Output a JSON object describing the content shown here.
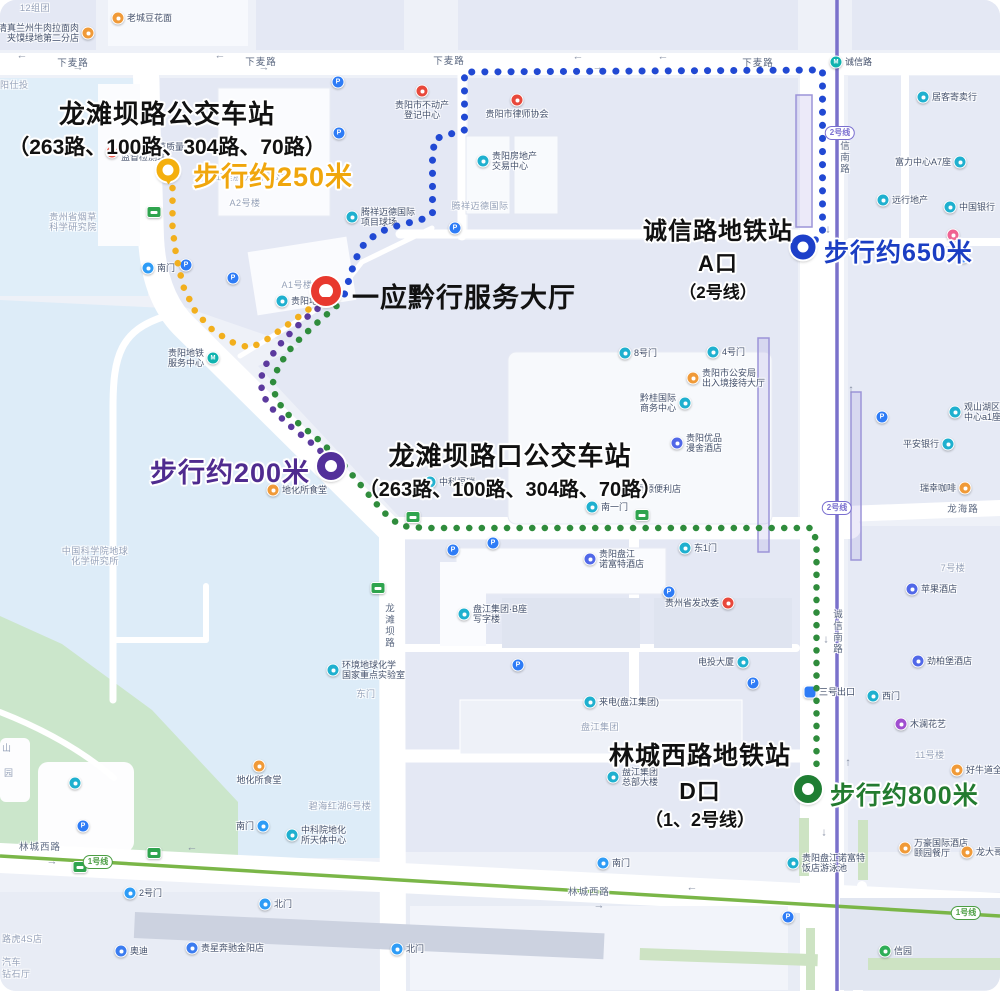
{
  "colors": {
    "route_yellow": "#F2AF1D",
    "route_blue": "#2149D3",
    "route_purple": "#5C3A9E",
    "route_green": "#2F8C3C",
    "walk_yellow": "#F0A60C",
    "walk_blue": "#1B3EC3",
    "walk_purple": "#4F2B8F",
    "walk_green": "#237B2F",
    "marker_red": "#E8392E",
    "metro_line2": "#7a71cb",
    "metro_line1": "#7ab648"
  },
  "stations": {
    "bus_longtanba": {
      "name": "龙滩坝路公交车站",
      "lines": "（263路、100路、304路、70路）",
      "walk": "步行约250米"
    },
    "metro_chengxin": {
      "name": "诚信路地铁站",
      "exit": "A口",
      "line": "（2号线）",
      "walk": "步行约650米"
    },
    "hall": {
      "name": "一应黔行服务大厅"
    },
    "bus_longtanbakou": {
      "name": "龙滩坝路口公交车站",
      "lines": "（263路、100路、304路、70路）",
      "walk": "步行约200米"
    },
    "metro_lincheng": {
      "name": "林城西路地铁站",
      "exit": "D口",
      "line": "（1、2号线）",
      "walk": "步行约800米"
    }
  },
  "markers": [
    {
      "id": "bus-longtanba",
      "type": "pin",
      "color": "#F4AF0D",
      "x": 168,
      "y": 170,
      "d": 11,
      "ring": 6
    },
    {
      "id": "service-hall",
      "type": "pin",
      "color": "#E8392E",
      "x": 326,
      "y": 291,
      "d": 14,
      "ring": 8
    },
    {
      "id": "metro-chengxin-a",
      "type": "donut",
      "color": "#1D3FC9",
      "x": 803,
      "y": 247,
      "d": 11,
      "ring": 7
    },
    {
      "id": "bus-longtanbakou",
      "type": "donut",
      "color": "#53309A",
      "x": 331,
      "y": 466,
      "d": 12,
      "ring": 8
    },
    {
      "id": "metro-lincheng-d",
      "type": "donut",
      "color": "#1F7E33",
      "x": 808,
      "y": 789,
      "d": 12,
      "ring": 8
    }
  ],
  "routes": [
    {
      "id": "yellow-250m",
      "color": "#F2AF1D",
      "w": 6.5,
      "gap": 12.5,
      "points": "168,188 168,228 172,258 179,287 191,312 208,330 227,342 246,348 263,339 287,322 306,308 319,298"
    },
    {
      "id": "blue-650m",
      "color": "#2149D3",
      "w": 7,
      "gap": 13,
      "points": "340,294 345,278 350,262 357,247 368,237 382,229 399,224 416,220 428,214 428,160 430,139 446,134 460,130 460,72 818,70 818,234 807,243"
    },
    {
      "id": "purple-200m",
      "color": "#5C3A9E",
      "w": 6.5,
      "gap": 12.5,
      "points": "323,301 300,319 279,340 263,361 256,379 258,395 268,409 282,423 298,436 312,447 321,456"
    },
    {
      "id": "green-800m",
      "color": "#2F8C3C",
      "w": 6.5,
      "gap": 12.5,
      "points": "332,306 309,326 288,346 274,366 268,384 272,400 283,414 297,426 312,438 327,452 342,468 357,486 372,504 384,517 397,526 420,528 808,528 812,542 812,766 809,774"
    }
  ],
  "road_labels": [
    {
      "t": "下麦路",
      "x": 73,
      "y": 62
    },
    {
      "t": "下麦路",
      "x": 261,
      "y": 61
    },
    {
      "t": "下麦路",
      "x": 449,
      "y": 60
    },
    {
      "t": "下麦路",
      "x": 758,
      "y": 62
    },
    {
      "t": "诚信南路",
      "x": 843,
      "y": 152,
      "v": true
    },
    {
      "t": "诚信南路",
      "x": 836,
      "y": 632,
      "v": true
    },
    {
      "t": "龙滩坝路",
      "x": 388,
      "y": 626,
      "v": true
    },
    {
      "t": "林城西路",
      "x": 40,
      "y": 846
    },
    {
      "t": "林城西路",
      "x": 589,
      "y": 891
    },
    {
      "t": "龙海路",
      "x": 963,
      "y": 508
    }
  ],
  "arrows": [
    {
      "g": "←",
      "x": 22,
      "y": 56
    },
    {
      "g": "→",
      "x": 78,
      "y": 68
    },
    {
      "g": "←",
      "x": 220,
      "y": 56
    },
    {
      "g": "→",
      "x": 264,
      "y": 68
    },
    {
      "g": "←",
      "x": 578,
      "y": 57
    },
    {
      "g": "→",
      "x": 598,
      "y": 68
    },
    {
      "g": "←",
      "x": 663,
      "y": 57
    },
    {
      "g": "→",
      "x": 52,
      "y": 862
    },
    {
      "g": "←",
      "x": 192,
      "y": 848
    },
    {
      "g": "←",
      "x": 692,
      "y": 888
    },
    {
      "g": "→",
      "x": 599,
      "y": 906
    },
    {
      "g": "↓",
      "x": 828,
      "y": 230
    },
    {
      "g": "↑",
      "x": 851,
      "y": 390
    },
    {
      "g": "↓",
      "x": 826,
      "y": 640
    },
    {
      "g": "↑",
      "x": 848,
      "y": 763
    },
    {
      "g": "↓",
      "x": 824,
      "y": 833
    }
  ],
  "badges": [
    {
      "t": "2号线",
      "x": 840,
      "y": 133,
      "c": "#7a6fd0"
    },
    {
      "t": "2号线",
      "x": 837,
      "y": 508,
      "c": "#7a6fd0"
    },
    {
      "t": "1号线",
      "x": 98,
      "y": 862,
      "c": "#4c9e43"
    },
    {
      "t": "1号线",
      "x": 966,
      "y": 913,
      "c": "#4c9e43"
    }
  ],
  "pois": [
    {
      "x": 118,
      "y": 18,
      "t": "orange",
      "l": "老城豆花面",
      "lp": "r"
    },
    {
      "x": 88,
      "y": 33,
      "t": "orange",
      "l": "清真兰州牛肉拉面肉\n夹馍绿地第二分店",
      "lp": "l"
    },
    {
      "x": 112,
      "y": 152,
      "t": "red",
      "l": "贵州省烟草质量\n监督检测站",
      "lp": "r"
    },
    {
      "x": 422,
      "y": 91,
      "t": "red",
      "l": "贵阳市不动产\n登记中心",
      "lp": "b"
    },
    {
      "x": 517,
      "y": 100,
      "t": "red",
      "l": "贵阳市律师协会",
      "lp": "b"
    },
    {
      "x": 483,
      "y": 161,
      "t": "cyan",
      "l": "贵阳房地产\n交易中心",
      "lp": "r"
    },
    {
      "x": 352,
      "y": 217,
      "t": "cyan",
      "l": "腾祥迈德国际\n项目球场",
      "lp": "r"
    },
    {
      "x": 693,
      "y": 378,
      "t": "orange",
      "l": "贵阳市公安局\n出入境接待大厅",
      "lp": "r"
    },
    {
      "x": 685,
      "y": 403,
      "t": "cyan",
      "l": "黔桂国际\n商务中心",
      "lp": "l"
    },
    {
      "x": 677,
      "y": 443,
      "t": "hotel",
      "l": "贵阳优品\n漫舍酒店",
      "lp": "r"
    },
    {
      "x": 625,
      "y": 353,
      "t": "cyan",
      "l": "8号门",
      "lp": "r"
    },
    {
      "x": 713,
      "y": 352,
      "t": "cyan",
      "l": "4号门",
      "lp": "r"
    },
    {
      "x": 592,
      "y": 507,
      "t": "cyan",
      "l": "南一门",
      "lp": "r"
    },
    {
      "x": 618,
      "y": 489,
      "t": "purple",
      "l": "幸福源便利店",
      "lp": "r"
    },
    {
      "x": 430,
      "y": 482,
      "t": "cyan",
      "l": "中科恒瑞",
      "lp": "r"
    },
    {
      "x": 273,
      "y": 490,
      "t": "orange",
      "l": "地化所食堂",
      "lp": "r"
    },
    {
      "x": 259,
      "y": 766,
      "t": "orange",
      "l": "地化所食堂",
      "lp": "b"
    },
    {
      "x": 333,
      "y": 670,
      "t": "cyan",
      "l": "环境地球化学\n国家重点实验室",
      "lp": "r"
    },
    {
      "x": 95,
      "y": 556,
      "t": "label",
      "l": "中国科学院地球\n化学研究所",
      "lp": "c"
    },
    {
      "x": 73,
      "y": 222,
      "t": "label",
      "l": "贵州省烟草\n科学研究院",
      "lp": "c"
    },
    {
      "x": 245,
      "y": 203,
      "t": "label",
      "l": "A2号楼",
      "lp": "c"
    },
    {
      "x": 297,
      "y": 285,
      "t": "label",
      "l": "A1号楼",
      "lp": "c"
    },
    {
      "x": 252,
      "y": 177,
      "t": "label",
      "l": "工程股份有限公司",
      "lp": "c"
    },
    {
      "x": 480,
      "y": 206,
      "t": "label",
      "l": "腾祥迈德国际",
      "lp": "c"
    },
    {
      "x": 600,
      "y": 727,
      "t": "label",
      "l": "盘江集团",
      "lp": "c"
    },
    {
      "x": 930,
      "y": 755,
      "t": "label",
      "l": "11号楼",
      "lp": "c"
    },
    {
      "x": 953,
      "y": 568,
      "t": "label",
      "l": "7号楼",
      "lp": "c"
    },
    {
      "x": 340,
      "y": 806,
      "t": "label",
      "l": "碧海红湖6号楼",
      "lp": "c"
    },
    {
      "x": 35,
      "y": 8,
      "t": "label",
      "l": "12组团",
      "lp": "c"
    },
    {
      "x": 0,
      "y": 85,
      "t": "label",
      "l": "阳仕投",
      "lp": "o"
    },
    {
      "x": 2,
      "y": 748,
      "t": "label",
      "l": "山",
      "lp": "o"
    },
    {
      "x": 4,
      "y": 773,
      "t": "label",
      "l": "园",
      "lp": "o"
    },
    {
      "x": 2,
      "y": 939,
      "t": "label",
      "l": "路虎4S店",
      "lp": "o"
    },
    {
      "x": 2,
      "y": 962,
      "t": "label",
      "l": "汽车",
      "lp": "o"
    },
    {
      "x": 2,
      "y": 974,
      "t": "label",
      "l": "钻石厅",
      "lp": "o"
    },
    {
      "x": 366,
      "y": 694,
      "t": "label",
      "l": "东门",
      "lp": "c"
    },
    {
      "x": 148,
      "y": 268,
      "t": "gate",
      "l": "南门",
      "lp": "r"
    },
    {
      "x": 613,
      "y": 777,
      "t": "cyan",
      "l": "盘江集团\n总部大楼",
      "lp": "r"
    },
    {
      "x": 590,
      "y": 702,
      "t": "cyan",
      "l": "来电(盘江集团)",
      "lp": "r"
    },
    {
      "x": 464,
      "y": 614,
      "t": "cyan",
      "l": "盘江集团·B座\n写字楼",
      "lp": "r"
    },
    {
      "x": 590,
      "y": 559,
      "t": "hotel",
      "l": "贵阳盘江\n诺富特酒店",
      "lp": "r"
    },
    {
      "x": 728,
      "y": 603,
      "t": "red",
      "l": "贵州省发改委",
      "lp": "l"
    },
    {
      "x": 743,
      "y": 662,
      "t": "cyan",
      "l": "电投大厦",
      "lp": "l"
    },
    {
      "x": 810,
      "y": 692,
      "t": "exit",
      "l": "三号出口",
      "lp": "r"
    },
    {
      "x": 873,
      "y": 696,
      "t": "cyan",
      "l": "西门",
      "lp": "r"
    },
    {
      "x": 901,
      "y": 724,
      "t": "purple",
      "l": "木澜花艺",
      "lp": "r"
    },
    {
      "x": 957,
      "y": 770,
      "t": "orange",
      "l": "好牛道全牛馆",
      "lp": "r"
    },
    {
      "x": 912,
      "y": 589,
      "t": "hotel",
      "l": "苹果酒店",
      "lp": "r"
    },
    {
      "x": 918,
      "y": 661,
      "t": "hotel",
      "l": "劲柏堡酒店",
      "lp": "r"
    },
    {
      "x": 923,
      "y": 97,
      "t": "cyan",
      "l": "居客寄卖行",
      "lp": "r"
    },
    {
      "x": 960,
      "y": 162,
      "t": "cyan",
      "l": "富力中心A7座",
      "lp": "l"
    },
    {
      "x": 883,
      "y": 200,
      "t": "cyan",
      "l": "远行地产",
      "lp": "r"
    },
    {
      "x": 950,
      "y": 207,
      "t": "cyan",
      "l": "中国银行",
      "lp": "r"
    },
    {
      "x": 953,
      "y": 235,
      "t": "pink",
      "l": "",
      "lp": "n"
    },
    {
      "x": 955,
      "y": 412,
      "t": "cyan",
      "l": "观山湖区富力\n中心a1座",
      "lp": "r"
    },
    {
      "x": 948,
      "y": 444,
      "t": "cyan",
      "l": "平安银行",
      "lp": "l"
    },
    {
      "x": 965,
      "y": 488,
      "t": "orange",
      "l": "瑞幸咖啡",
      "lp": "l"
    },
    {
      "x": 885,
      "y": 951,
      "t": "green",
      "l": "信园",
      "lp": "r"
    },
    {
      "x": 793,
      "y": 863,
      "t": "cyan",
      "l": "贵阳盘江诺富特\n饭店游泳池",
      "lp": "r"
    },
    {
      "x": 603,
      "y": 863,
      "t": "gate",
      "l": "南门",
      "lp": "r"
    },
    {
      "x": 905,
      "y": 848,
      "t": "orange",
      "l": "万豪国际酒店\n颐园餐厅",
      "lp": "r"
    },
    {
      "x": 967,
      "y": 852,
      "t": "orange",
      "l": "龙大哥",
      "lp": "r"
    },
    {
      "x": 263,
      "y": 826,
      "t": "gate",
      "l": "南门",
      "lp": "l"
    },
    {
      "x": 292,
      "y": 835,
      "t": "cyan",
      "l": "中科院地化\n所天体中心",
      "lp": "r"
    },
    {
      "x": 130,
      "y": 893,
      "t": "gate",
      "l": "2号门",
      "lp": "r"
    },
    {
      "x": 265,
      "y": 904,
      "t": "gate",
      "l": "北门",
      "lp": "r"
    },
    {
      "x": 397,
      "y": 949,
      "t": "gate",
      "l": "北门",
      "lp": "r"
    },
    {
      "x": 121,
      "y": 951,
      "t": "car",
      "l": "奥迪",
      "lp": "r"
    },
    {
      "x": 192,
      "y": 948,
      "t": "car",
      "l": "贵星奔驰金阳店",
      "lp": "r"
    },
    {
      "x": 213,
      "y": 358,
      "t": "metro",
      "l": "贵阳地铁\n服务中心",
      "lp": "l"
    },
    {
      "x": 282,
      "y": 301,
      "t": "cyan",
      "l": "贵阳地铁",
      "lp": "r"
    },
    {
      "x": 836,
      "y": 62,
      "t": "metro",
      "l": "诚信路",
      "lp": "r"
    },
    {
      "x": 685,
      "y": 548,
      "t": "cyan",
      "l": "东1门",
      "lp": "r"
    },
    {
      "x": 75,
      "y": 783,
      "t": "cyan",
      "l": "",
      "lp": "n"
    },
    {
      "x": 338,
      "y": 82,
      "t": "park",
      "l": "",
      "lp": "n"
    },
    {
      "x": 339,
      "y": 133,
      "t": "park",
      "l": "",
      "lp": "n"
    },
    {
      "x": 455,
      "y": 228,
      "t": "park",
      "l": "",
      "lp": "n"
    },
    {
      "x": 186,
      "y": 265,
      "t": "park",
      "l": "",
      "lp": "n"
    },
    {
      "x": 233,
      "y": 278,
      "t": "park",
      "l": "",
      "lp": "n"
    },
    {
      "x": 493,
      "y": 543,
      "t": "park",
      "l": "",
      "lp": "n"
    },
    {
      "x": 453,
      "y": 550,
      "t": "park",
      "l": "",
      "lp": "n"
    },
    {
      "x": 669,
      "y": 592,
      "t": "park",
      "l": "",
      "lp": "n"
    },
    {
      "x": 518,
      "y": 665,
      "t": "park",
      "l": "",
      "lp": "n"
    },
    {
      "x": 753,
      "y": 683,
      "t": "park",
      "l": "",
      "lp": "n"
    },
    {
      "x": 83,
      "y": 826,
      "t": "park",
      "l": "",
      "lp": "n"
    },
    {
      "x": 788,
      "y": 917,
      "t": "park",
      "l": "",
      "lp": "n"
    },
    {
      "x": 882,
      "y": 417,
      "t": "park",
      "l": "",
      "lp": "n"
    },
    {
      "x": 963,
      "y": 257,
      "t": "park",
      "l": "",
      "lp": "n"
    },
    {
      "x": 154,
      "y": 212,
      "t": "bus",
      "l": "",
      "lp": "n"
    },
    {
      "x": 413,
      "y": 517,
      "t": "bus",
      "l": "",
      "lp": "n"
    },
    {
      "x": 642,
      "y": 515,
      "t": "bus",
      "l": "",
      "lp": "n"
    },
    {
      "x": 378,
      "y": 588,
      "t": "bus",
      "l": "",
      "lp": "n"
    },
    {
      "x": 154,
      "y": 853,
      "t": "bus",
      "l": "",
      "lp": "n"
    },
    {
      "x": 80,
      "y": 867,
      "t": "bus",
      "l": "",
      "lp": "n"
    }
  ]
}
